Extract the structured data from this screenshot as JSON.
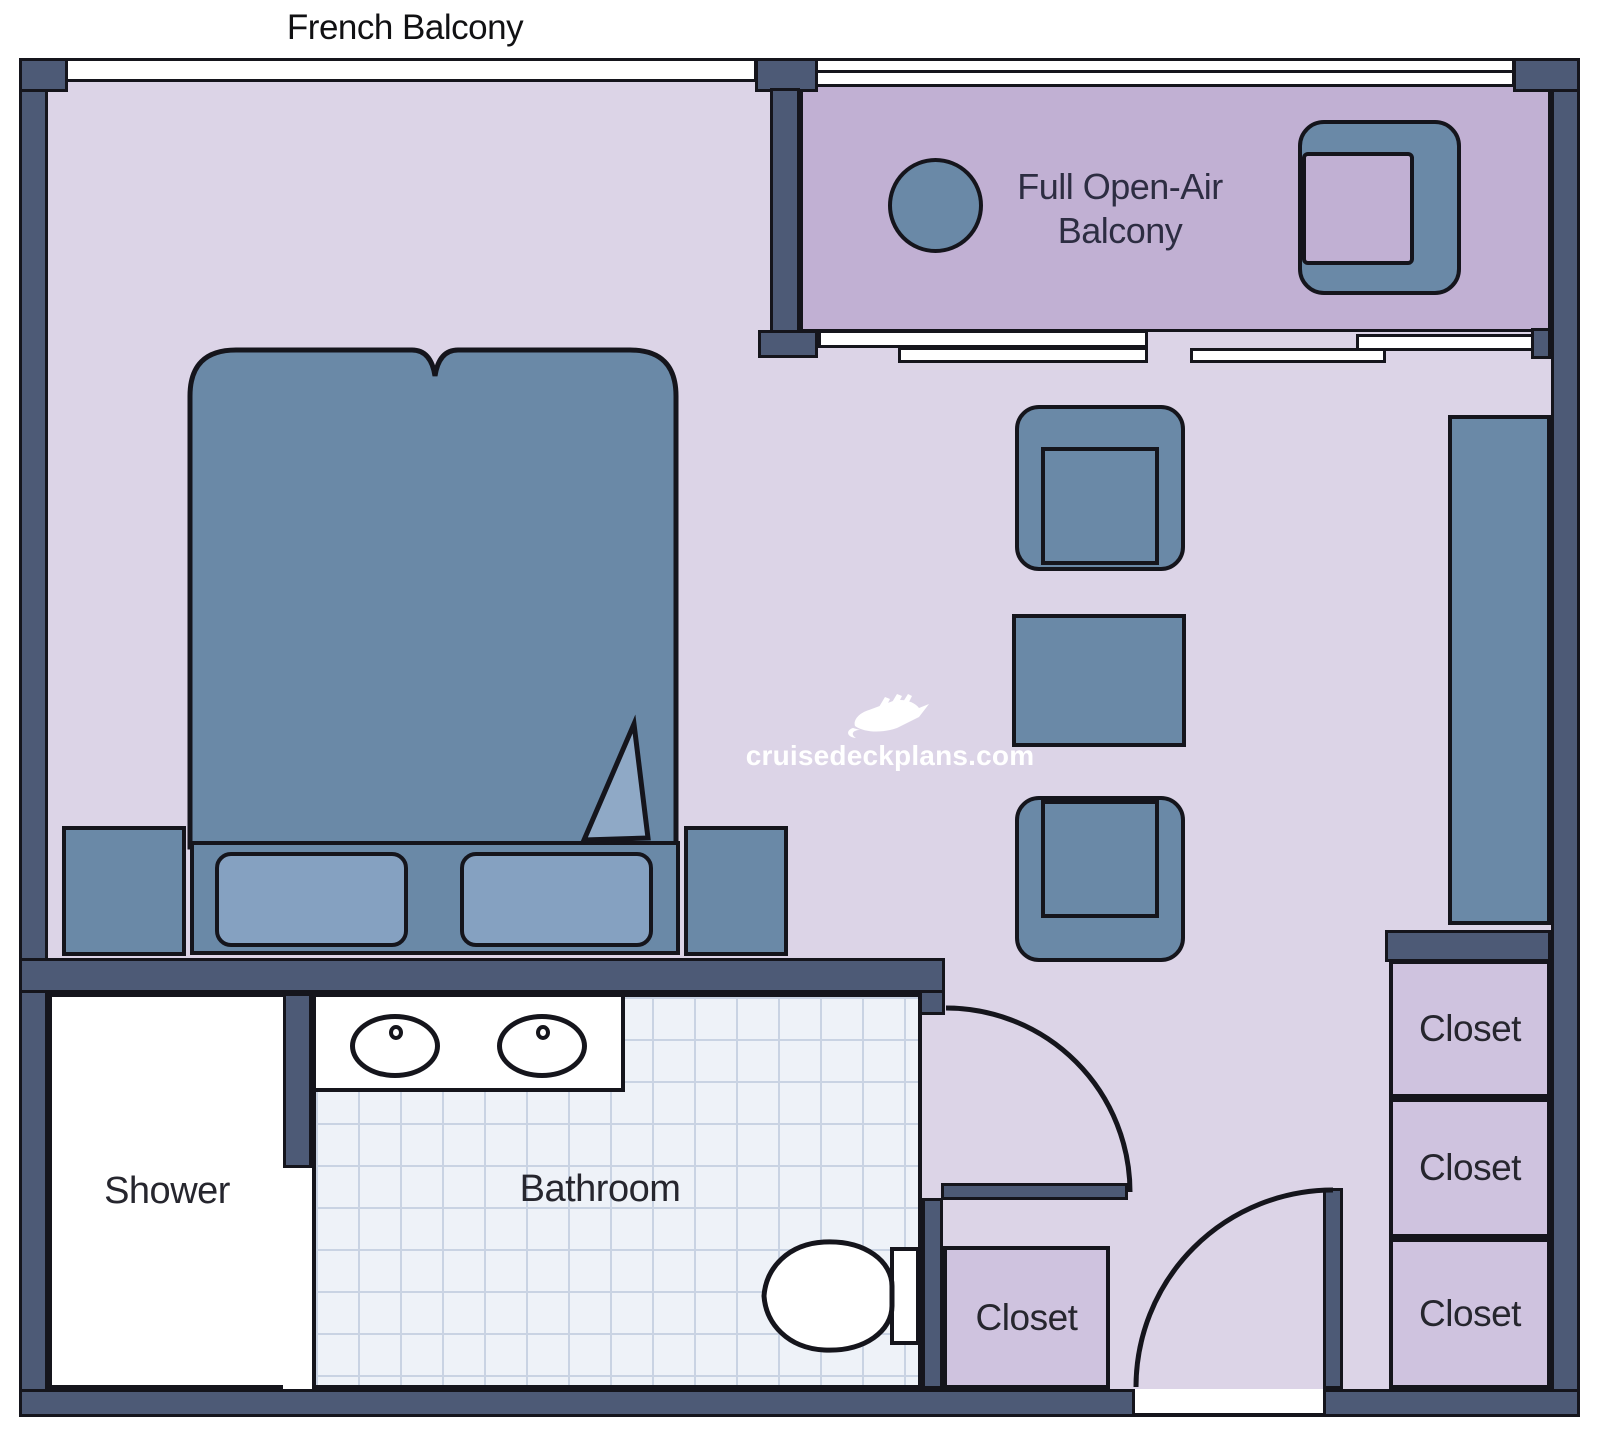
{
  "title": "French Balcony",
  "labels": {
    "balcony_line1": "Full Open-Air",
    "balcony_line2": "Balcony",
    "shower": "Shower",
    "bathroom": "Bathroom",
    "closet_middle": "Closet",
    "closet_right_top": "Closet",
    "closet_right_middle": "Closet",
    "closet_right_bottom": "Closet"
  },
  "watermark": {
    "text": "cruisedeckplans.com",
    "icon": "cruise-ship-icon"
  },
  "colors": {
    "wall": "#4d5a76",
    "outline": "#15151c",
    "room_floor": "#dcd4e7",
    "balcony_floor": "#c1b0d3",
    "closet_fill": "#cfc3df",
    "furniture_blue": "#6a89a7",
    "pillow_blue": "#85a1c1",
    "duvet_fold": "#8fa9c6",
    "tile": "#eef2f8",
    "tile_grid": "#c9d3e3",
    "label_text": "#26262e",
    "watermark_text": "#ffffff"
  },
  "rooms": [
    "bedroom",
    "living-area",
    "full-open-air-balcony",
    "bathroom",
    "shower",
    "closets"
  ],
  "furniture": [
    "double-bed",
    "pillows",
    "nightstands",
    "armchairs",
    "coffee-table",
    "balcony-table",
    "balcony-chair",
    "wall-sofa",
    "double-sink-vanity",
    "toilet"
  ]
}
